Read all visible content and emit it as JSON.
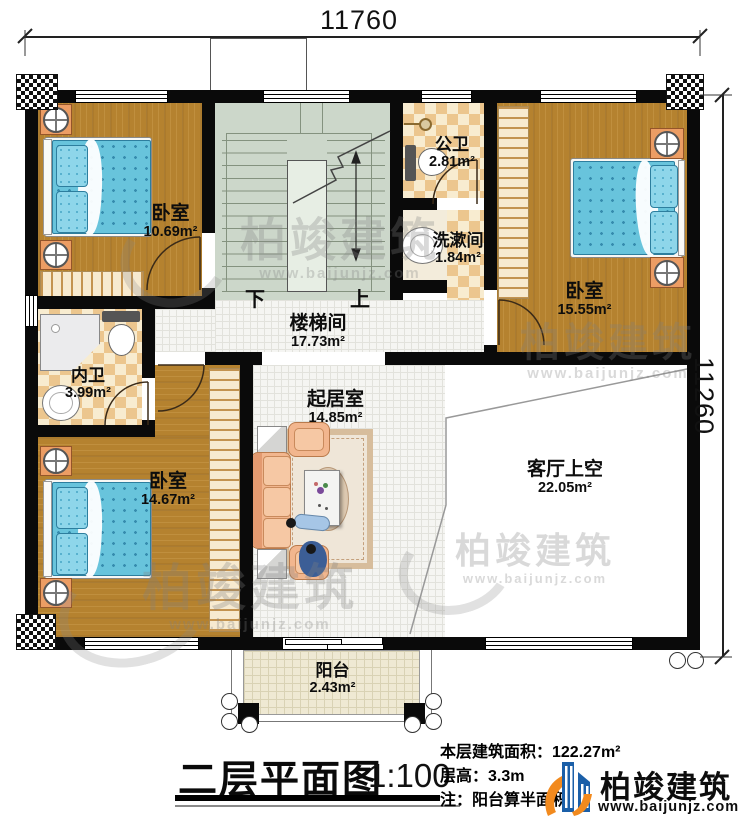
{
  "dimensions": {
    "width": "11760",
    "height": "11260"
  },
  "rooms": {
    "bedroom_tl": {
      "name": "卧室",
      "area": "10.69m²"
    },
    "public_bath": {
      "name": "公卫",
      "area": "2.81m²"
    },
    "washroom": {
      "name": "洗漱间",
      "area": "1.84m²"
    },
    "bedroom_tr": {
      "name": "卧室",
      "area": "15.55m²"
    },
    "stairwell": {
      "name": "楼梯间",
      "area": "17.73m²"
    },
    "private_bath": {
      "name": "内卫",
      "area": "3.99m²"
    },
    "bedroom_bl": {
      "name": "卧室",
      "area": "14.67m²"
    },
    "living_room": {
      "name": "起居室",
      "area": "14.85m²"
    },
    "void_above_living": {
      "name": "客厅上空",
      "area": "22.05m²"
    },
    "balcony": {
      "name": "阳台",
      "area": "2.43m²"
    }
  },
  "stairs": {
    "down": "下",
    "up": "上"
  },
  "title": {
    "name": "二层平面图",
    "scale": "1:100"
  },
  "info": {
    "floor_area": "本层建筑面积：122.27m²",
    "floor_height": "层高：3.3m",
    "note": "注：阳台算半面积"
  },
  "brand": {
    "name": "柏竣建筑",
    "site": "www.baijunjz.com"
  }
}
